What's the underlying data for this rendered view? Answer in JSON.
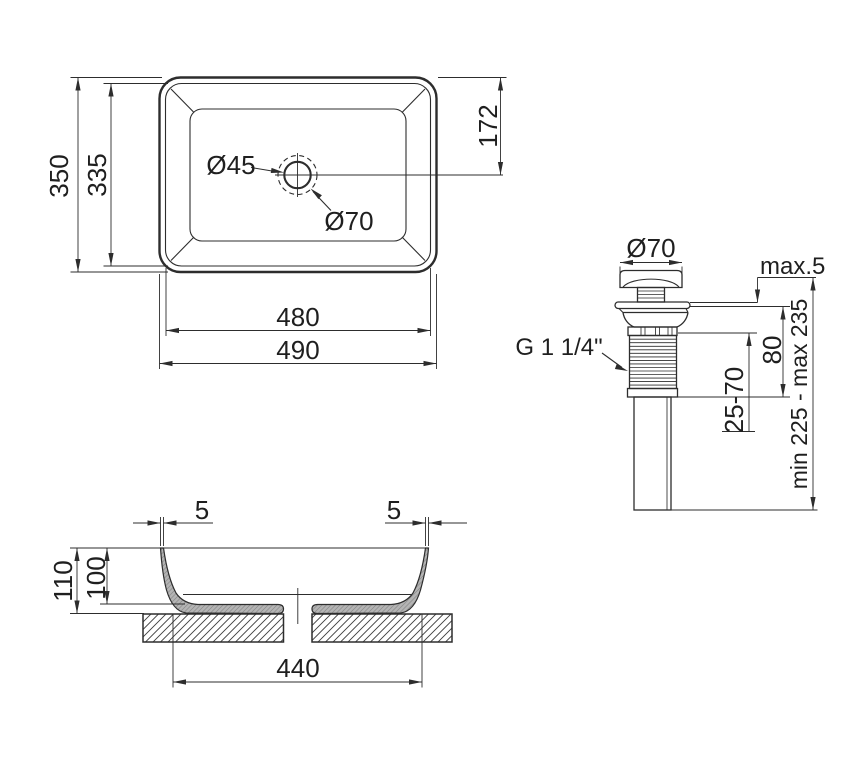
{
  "colors": {
    "line": "#2d2d2d",
    "section_fill": "#b4b4b4",
    "background": "#ffffff"
  },
  "top_view": {
    "height_outer": "350",
    "height_inner": "335",
    "drain_offset": "172",
    "drain_hole_diameter": "Ø45",
    "drain_outer_diameter": "Ø70",
    "width_inner": "480",
    "width_outer": "490"
  },
  "section_view": {
    "wall_thickness_left": "5",
    "wall_thickness_right": "5",
    "height_total": "110",
    "basin_depth": "100",
    "base_width": "440"
  },
  "valve_view": {
    "cap_diameter": "Ø70",
    "above_surface": "max.5",
    "thread_size": "G 1 1/4\"",
    "body_height": "80",
    "clamp_range": "25-70",
    "total_height": "min 225 - max 235"
  }
}
